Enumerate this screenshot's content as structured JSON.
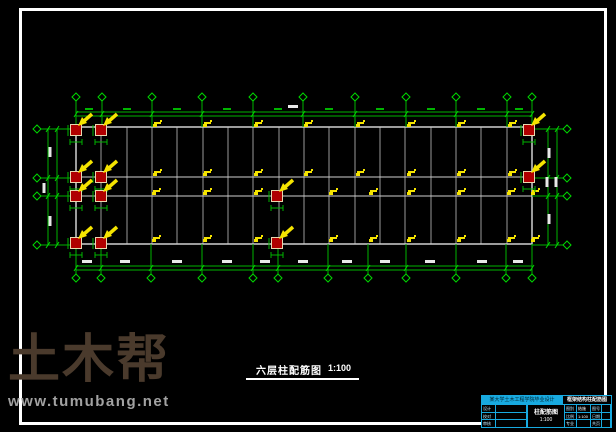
{
  "page": {
    "background": "#000000"
  },
  "frame": {
    "color": "#ffffff"
  },
  "drawing_title": {
    "text": "六层柱配筋图",
    "scale": "1:100"
  },
  "watermark": {
    "brand": "土木帮",
    "url": "www.tumubang.net",
    "brand_color": "#4a3a2c",
    "url_color": "#a2a2a2"
  },
  "title_block": {
    "border_color": "#18aae0",
    "header_left": "某大学土木工程学院毕业设计",
    "header_right": "框架结构柱配筋图",
    "center_title": "柱配筋图",
    "center_scale": "1:100",
    "left_rows": [
      [
        "设计",
        ""
      ],
      [
        "校对",
        ""
      ],
      [
        "审核",
        ""
      ]
    ],
    "right_rows": [
      [
        "图别",
        "结施",
        "图号",
        ""
      ],
      [
        "比例",
        "1:100",
        "日期",
        ""
      ],
      [
        "专业",
        "",
        "共页",
        ""
      ]
    ]
  },
  "colors": {
    "axis": "#00b400",
    "axis_bright": "#00d800",
    "wall": "#d0d0d0",
    "beam": "#9a9a9a",
    "column_fill": "#b00000",
    "column_stroke": "#e8d8b0",
    "tag": "#f5e400",
    "arrow": "#f5e400",
    "dim_text": "#e8e8e8"
  },
  "geometry": {
    "building": {
      "x1": 76,
      "y1": 127,
      "x2": 532,
      "y2": 244
    },
    "inner_v_x": [
      101,
      127,
      152,
      177,
      203,
      228,
      253,
      279,
      304,
      329,
      355,
      380,
      405,
      431,
      456,
      481,
      507
    ],
    "inner_h_y": [
      177,
      196
    ],
    "top_axes_x": [
      76,
      102,
      152,
      202,
      253,
      303,
      355,
      406,
      456,
      507,
      532
    ],
    "bottom_axes_x": [
      76,
      101,
      151,
      202,
      253,
      278,
      328,
      368,
      406,
      456,
      506,
      532
    ],
    "side_rows_y": [
      129,
      178,
      196,
      245
    ],
    "top_dim": {
      "diamond_y": 97,
      "line_y1": 112,
      "line_y2": 116,
      "dash_y": 108
    },
    "bottom_dim": {
      "diamond_y": 278,
      "line_y1": 266,
      "line_y2": 270,
      "blob_y": 260
    },
    "left_dim": {
      "diamond_x": 37,
      "line_x1": 48,
      "line_x2": 57
    },
    "right_dim": {
      "diamond_x": 567,
      "line_x1": 548,
      "line_x2": 557
    },
    "red_columns": [
      [
        76,
        130
      ],
      [
        101,
        130
      ],
      [
        76,
        177
      ],
      [
        101,
        177
      ],
      [
        76,
        196
      ],
      [
        101,
        196
      ],
      [
        76,
        243
      ],
      [
        101,
        243
      ],
      [
        277,
        196
      ],
      [
        277,
        243
      ],
      [
        529,
        130
      ],
      [
        529,
        177
      ]
    ],
    "tag_rows": [
      {
        "y": 128,
        "x": [
          152,
          202,
          253,
          303,
          355,
          406,
          456,
          507
        ]
      },
      {
        "y": 177,
        "x": [
          152,
          202,
          253,
          303,
          355,
          406,
          456,
          507
        ]
      },
      {
        "y": 196,
        "x": [
          151,
          202,
          253,
          328,
          368,
          406,
          456,
          506,
          530
        ]
      },
      {
        "y": 243,
        "x": [
          151,
          202,
          253,
          328,
          368,
          406,
          456,
          506,
          530
        ]
      }
    ],
    "green_dash_top_x": [
      89,
      127,
      177,
      227,
      278,
      329,
      380,
      431,
      481,
      519
    ],
    "blob_top": [
      [
        293,
        107
      ]
    ],
    "blob_bottom_x": [
      87,
      125,
      177,
      227,
      265,
      303,
      347,
      385,
      430,
      482,
      518
    ],
    "blob_left": [
      [
        50,
        152
      ],
      [
        44,
        188
      ],
      [
        50,
        221
      ]
    ],
    "blob_right": [
      [
        549,
        153
      ],
      [
        547,
        182
      ],
      [
        556,
        182
      ],
      [
        549,
        219
      ]
    ]
  }
}
